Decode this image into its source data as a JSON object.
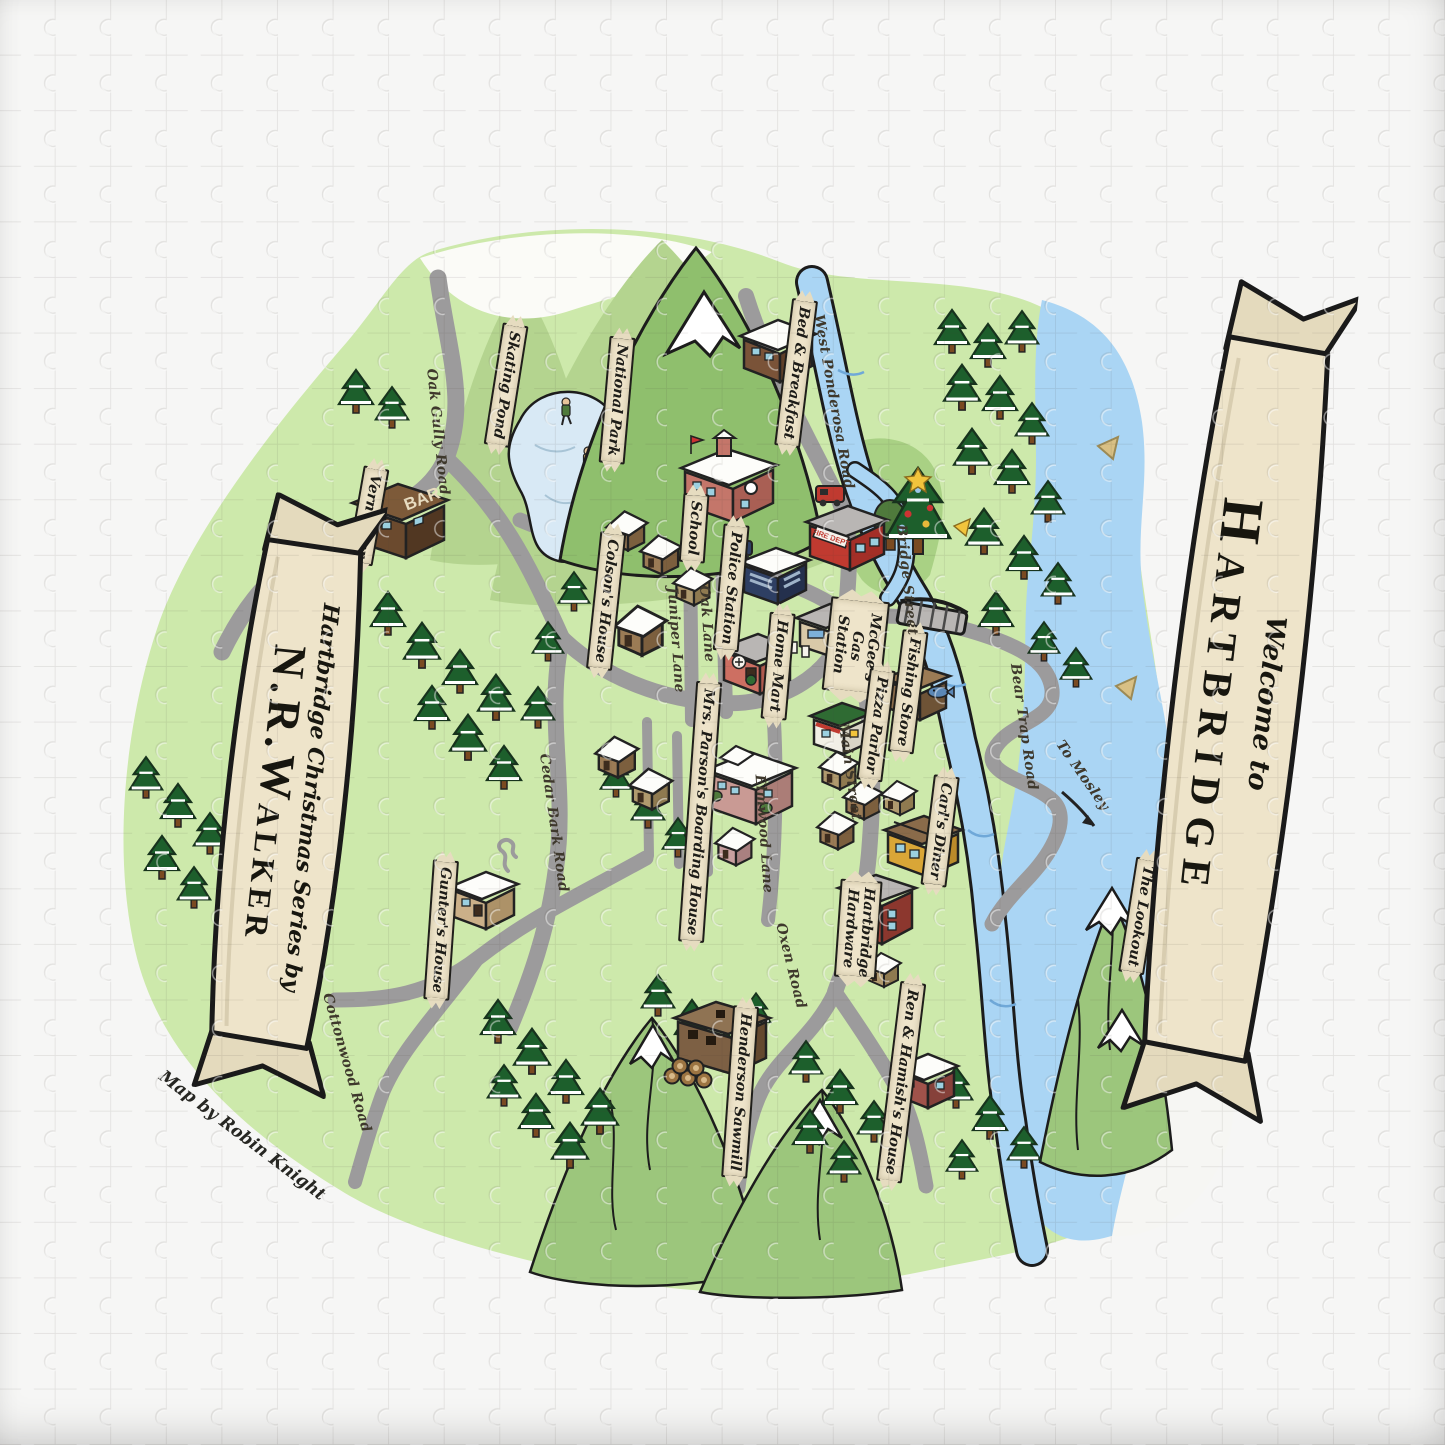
{
  "puzzle": {
    "title": "Welcome to Hartbridge illustrated map jigsaw puzzle",
    "welcome_banner": {
      "line1": "Welcome to",
      "line2": "Hartbridge"
    },
    "series_banner": {
      "line1": "Hartbridge Christmas Series by",
      "line2": "N.R.Walker"
    },
    "signs": {
      "bar": "BAR",
      "fire_department": "FIRE DEPT"
    },
    "labels": [
      {
        "text": "Vern's Bar",
        "kind": "banner"
      },
      {
        "text": "Skating Pond",
        "kind": "banner"
      },
      {
        "text": "National Park",
        "kind": "banner"
      },
      {
        "text": "School",
        "kind": "banner"
      },
      {
        "text": "Bed & Breakfast",
        "kind": "banner"
      },
      {
        "text": "Police Station",
        "kind": "banner"
      },
      {
        "text": "Colson's House",
        "kind": "banner"
      },
      {
        "text": "Home Mart",
        "kind": "banner"
      },
      {
        "text": "McGee's Gas Station",
        "kind": "banner"
      },
      {
        "text": "Fishing Store",
        "kind": "banner"
      },
      {
        "text": "Pizza Parlor",
        "kind": "banner"
      },
      {
        "text": "Mrs. Parson's Boarding House",
        "kind": "banner"
      },
      {
        "text": "Gunter's House",
        "kind": "banner"
      },
      {
        "text": "Carl's Diner",
        "kind": "banner"
      },
      {
        "text": "Hartbridge Hardware",
        "kind": "banner"
      },
      {
        "text": "Henderson Sawmill",
        "kind": "banner"
      },
      {
        "text": "Ren & Hamish's House",
        "kind": "banner"
      },
      {
        "text": "The Lookout",
        "kind": "banner"
      },
      {
        "text": "Oak Gully Road",
        "kind": "road"
      },
      {
        "text": "West Ponderosa Road",
        "kind": "road"
      },
      {
        "text": "Bridge Street",
        "kind": "road"
      },
      {
        "text": "Oak Lane",
        "kind": "road"
      },
      {
        "text": "Juniper Lane",
        "kind": "road"
      },
      {
        "text": "Elmwood Lane",
        "kind": "road"
      },
      {
        "text": "Main Street",
        "kind": "road"
      },
      {
        "text": "Cedar Bark Road",
        "kind": "road"
      },
      {
        "text": "Cottonwood Road",
        "kind": "road"
      },
      {
        "text": "Bear Trap Road",
        "kind": "road"
      },
      {
        "text": "Oxen Road",
        "kind": "road"
      },
      {
        "text": "To Mosley",
        "kind": "road"
      },
      {
        "text": "Map by Robin Knight",
        "kind": "credit"
      }
    ],
    "colors": {
      "map_green": "#cde9ab",
      "park_green": "#a9d184",
      "mountain_green": "#9cc67c",
      "forest_dark": "#1d5f2c",
      "water_blue": "#aad5f4",
      "road_gray": "#9c9b9c",
      "banner_cream": "#eee4ca",
      "outline_black": "#1c1c1c"
    }
  }
}
